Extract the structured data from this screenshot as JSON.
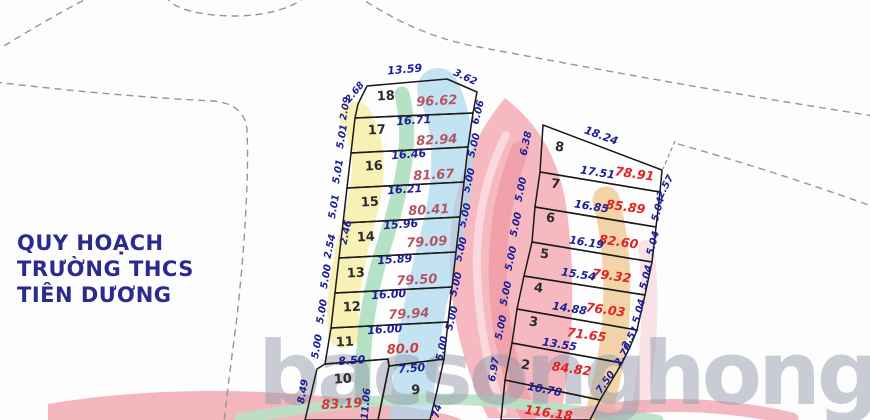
{
  "title": {
    "lines": [
      "QUY HOẠCH",
      "TRƯỜNG THCS",
      "TIÊN DƯƠNG"
    ]
  },
  "watermark": {
    "text": "bacsonghong"
  },
  "colors": {
    "title": "#2b2b8e",
    "dim_label": "#1c1e96",
    "plot_number": "#2b2b2b",
    "area_left": "#b25663",
    "area_bright": "#d03a3a",
    "area_right": "#e02525",
    "plot_line": "#1a1a1a",
    "boundary_dash": "#a2908a"
  },
  "left_block": {
    "plots": [
      {
        "number": "18",
        "area": "96.62",
        "dims": {
          "top": "13.59",
          "top_right": "3.62",
          "left_upper": "2.68",
          "left_lower": "2.09",
          "bottom": "16.71",
          "right": "6.06"
        }
      },
      {
        "number": "17",
        "area": "82.94",
        "dims": {
          "left": "5.01",
          "bottom": "16.46",
          "right": "5.00"
        }
      },
      {
        "number": "16",
        "area": "81.67",
        "dims": {
          "left": "5.01",
          "bottom": "16.21",
          "right": "5.00"
        }
      },
      {
        "number": "15",
        "area": "80.41",
        "dims": {
          "left": "5.01",
          "bottom": "15.96",
          "right": "5.00"
        }
      },
      {
        "number": "14",
        "area": "79.09",
        "dims": {
          "left_inner": "2.46",
          "left_outer": "2.54",
          "bottom": "15.89",
          "right": "5.00"
        }
      },
      {
        "number": "13",
        "area": "79.50",
        "dims": {
          "left": "5.00",
          "bottom": "16.00",
          "right": "5.00"
        }
      },
      {
        "number": "12",
        "area": "79.94",
        "dims": {
          "left": "5.00",
          "bottom": "16.00",
          "right": "5.00"
        }
      },
      {
        "number": "11",
        "area": "80.0",
        "dims": {
          "left": "5.00",
          "bottom_left": "8.50",
          "bottom_right": "7.50",
          "right": "5.00"
        }
      },
      {
        "number": "10",
        "area": "83.19",
        "dims": {
          "left": "8.49",
          "right": "11.06"
        }
      },
      {
        "number": "9",
        "dims": {
          "right_partial": "74"
        }
      }
    ]
  },
  "right_block": {
    "plots": [
      {
        "number": "8",
        "area": "78.91",
        "dims": {
          "top": "18.24",
          "left": "6.38",
          "bottom": "17.51",
          "tie": "2.57"
        }
      },
      {
        "number": "7",
        "area": "85.89",
        "dims": {
          "left": "5.00",
          "bottom": "16.85",
          "right": "5.04"
        }
      },
      {
        "number": "6",
        "area": "82.60",
        "dims": {
          "left": "5.00",
          "bottom": "16.19",
          "right": "5.04"
        }
      },
      {
        "number": "5",
        "area": "79.32",
        "dims": {
          "left": "5.00",
          "bottom": "15.54",
          "right": "5.04"
        }
      },
      {
        "number": "4",
        "area": "76.03",
        "dims": {
          "left": "5.00",
          "bottom": "14.88",
          "right": "5.04"
        }
      },
      {
        "number": "3",
        "area": "71.65",
        "dims": {
          "left": "5.00",
          "bottom": "13.55",
          "right_upper": "2.51",
          "right_lower": "2.70"
        }
      },
      {
        "number": "2",
        "area": "84.82",
        "dims": {
          "left": "6.97",
          "bottom": "10.78",
          "right": "7.50"
        }
      },
      {
        "number": "1",
        "area": "116.18"
      }
    ]
  }
}
